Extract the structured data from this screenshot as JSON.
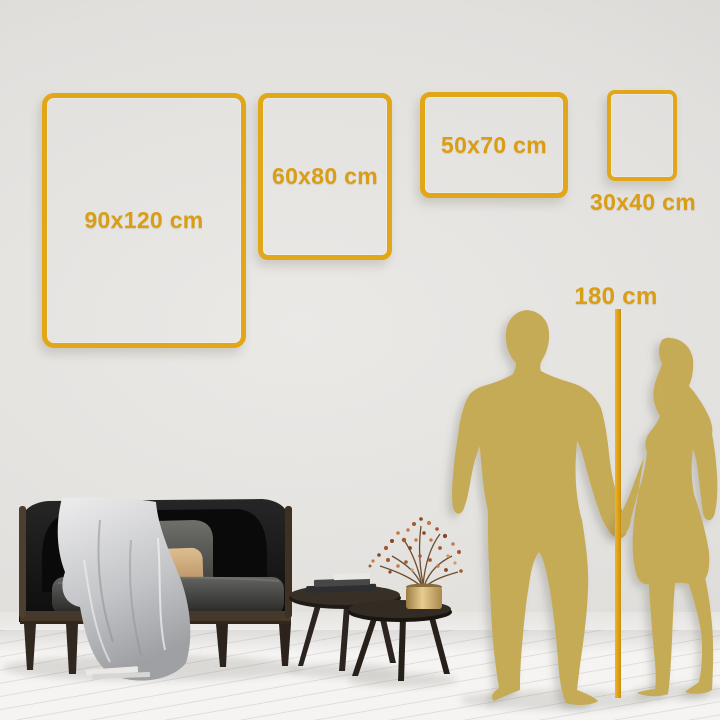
{
  "size_guide": {
    "frames": [
      {
        "label": "90x120 cm",
        "orientation": "portrait"
      },
      {
        "label": "60x80 cm",
        "orientation": "portrait"
      },
      {
        "label": "50x70 cm",
        "orientation": "landscape"
      },
      {
        "label": "30x40 cm",
        "orientation": "portrait"
      }
    ],
    "reference": {
      "label": "180 cm"
    }
  },
  "colors": {
    "accent_gold": "#E2A718",
    "text_gold": "#D99E16",
    "silhouette_gold": "#C6AB57",
    "wall": "#E2E0DD",
    "floor": "#F5F4F2"
  },
  "icons": {
    "man": "man-silhouette-icon",
    "woman": "woman-silhouette-icon",
    "height_line": "height-measure-line",
    "sofa": "sofa-illustration",
    "tables": "coffee-tables-illustration",
    "plant": "vase-plant-illustration"
  }
}
